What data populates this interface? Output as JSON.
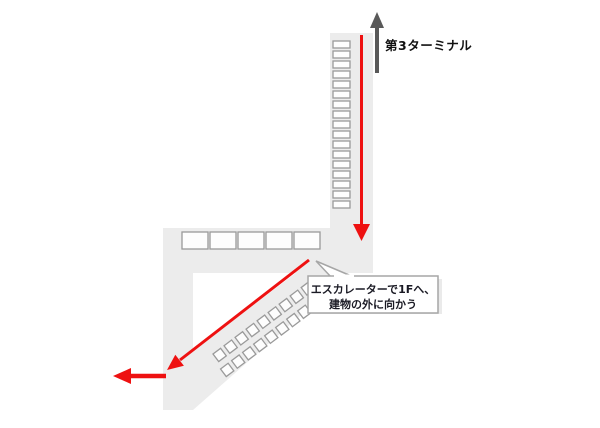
{
  "diagram": {
    "terminal_label": "第3ターミナル",
    "callout": {
      "line1": "エスカレーターで1Fへ、",
      "line2": "建物の外に向かう"
    },
    "colors": {
      "route_red": "#ee1111",
      "terminal_arrow_gray": "#595959",
      "floor_gray": "#ececec",
      "segment_border": "#9a9a9a",
      "callout_border": "#a6a6a6"
    },
    "walkway": {
      "vertical_segment_count": 17,
      "hall_segment_count": 5,
      "escalator_step_rows": [
        9,
        10
      ]
    }
  }
}
